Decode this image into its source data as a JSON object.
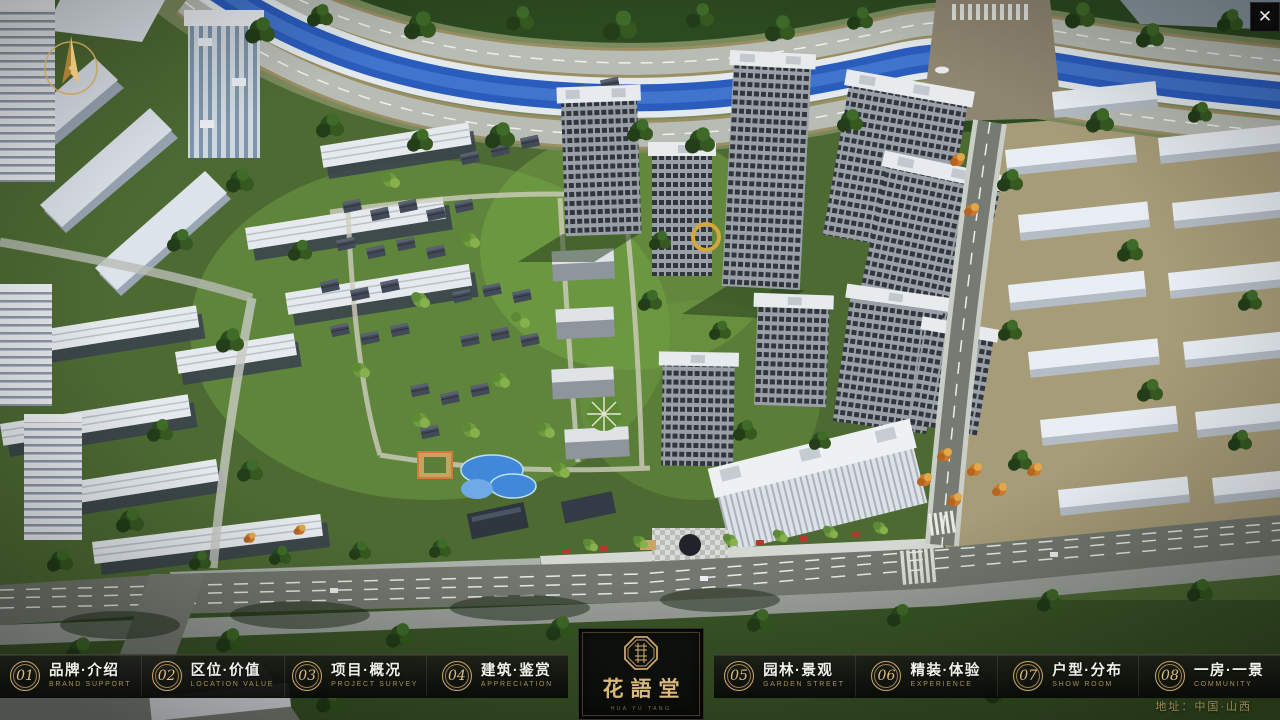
{
  "app": {
    "close_icon": "✕"
  },
  "brand": {
    "name": "花語堂",
    "tagline": "HUA YU TANG"
  },
  "nav": {
    "items": [
      {
        "num": "01",
        "label": "品牌·介绍",
        "sub": "BRAND SUPPORT"
      },
      {
        "num": "02",
        "label": "区位·价值",
        "sub": "LOCATION VALUE"
      },
      {
        "num": "03",
        "label": "项目·概况",
        "sub": "PROJECT SURVEY"
      },
      {
        "num": "04",
        "label": "建筑·鉴赏",
        "sub": "APPRECIATION"
      },
      {
        "num": "05",
        "label": "园林·景观",
        "sub": "GARDEN STREET"
      },
      {
        "num": "06",
        "label": "精装·体验",
        "sub": "EXPERIENCE"
      },
      {
        "num": "07",
        "label": "户型·分布",
        "sub": "SHOW ROOM"
      },
      {
        "num": "08",
        "label": "一房·一景",
        "sub": "COMMUNITY"
      }
    ]
  },
  "footer": {
    "address": "地址：中国·山西"
  },
  "colors": {
    "gold": "#c9a76a",
    "river_blue": "#2e62c4",
    "foliage": "#3a5a28",
    "asphalt": "#72786f"
  }
}
